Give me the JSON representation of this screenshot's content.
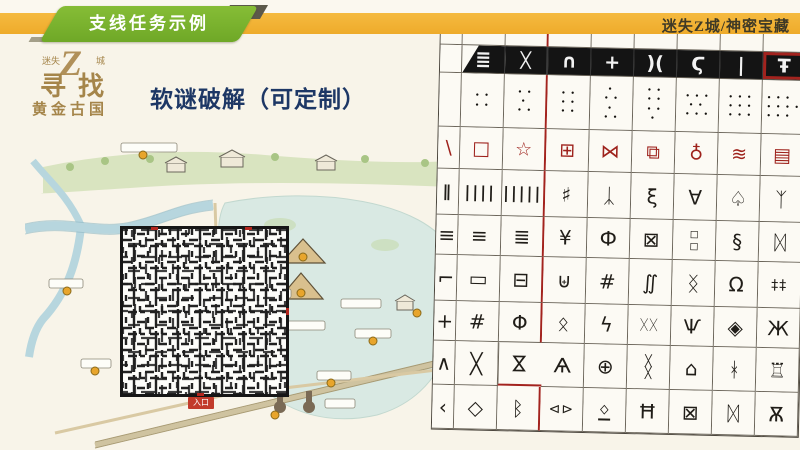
{
  "header": {
    "bar_color": "#F1B134",
    "badge": {
      "label": "支线任务示例",
      "color": "#77B22B"
    },
    "project": "迷失Z城/神密宝藏"
  },
  "logo": {
    "top_left": "迷失",
    "z": "Z",
    "top_right": "城",
    "mid": "寻找",
    "bottom": "黄金古国",
    "gold_color": "#A5854A"
  },
  "title": "软谜破解（可定制）",
  "title_color": "#1D3765",
  "map": {
    "entrance_label": "入口",
    "maze": "black-and-white square maze overlay",
    "marker_color": "#E8A52C"
  },
  "table": {
    "accent_red": "#A3231E",
    "description": "grid of ancient pictographic numeral symbols, slightly tilted, right edge cropped",
    "rows": [
      [
        {
          "g": ""
        },
        {
          "g": ""
        },
        {
          "g": ""
        },
        {
          "g": ""
        },
        {
          "g": ""
        },
        {
          "g": ""
        },
        {
          "g": ""
        },
        {
          "g": ""
        },
        {
          "g": ""
        }
      ],
      [
        {
          "g": ""
        },
        {
          "g": "≣",
          "k": "band bandL"
        },
        {
          "g": "ᚷ",
          "k": "band"
        },
        {
          "g": "∩",
          "k": "band"
        },
        {
          "g": "+",
          "k": "band"
        },
        {
          "g": ")(",
          "k": "band"
        },
        {
          "g": "Ϛ",
          "k": "band"
        },
        {
          "g": "|",
          "k": "band"
        },
        {
          "g": "Ŧ",
          "k": "band redbox"
        }
      ],
      [
        {
          "g": "",
          "k": "dots"
        },
        {
          "g": "• •\n• •",
          "k": "dots"
        },
        {
          "g": "• •\n •\n• •",
          "k": "dots"
        },
        {
          "g": "• •\n• •\n• •",
          "k": "dots"
        },
        {
          "g": " •\n• •\n •\n• •",
          "k": "dots"
        },
        {
          "g": "• •\n• •\n• •\n •",
          "k": "dots"
        },
        {
          "g": "• • •\n • •\n• • •",
          "k": "dots"
        },
        {
          "g": "• • •\n• • •\n• • •",
          "k": "dots"
        },
        {
          "g": "• • •\n• • • •\n• • •",
          "k": "dots"
        }
      ],
      [
        {
          "g": "\\",
          "k": "red"
        },
        {
          "g": "□",
          "k": "red"
        },
        {
          "g": "☆",
          "k": "red"
        },
        {
          "g": "⊞",
          "k": "red"
        },
        {
          "g": "⋈",
          "k": "red"
        },
        {
          "g": "⧉",
          "k": "red"
        },
        {
          "g": "♁",
          "k": "red"
        },
        {
          "g": "≋",
          "k": "red"
        },
        {
          "g": "▤",
          "k": "red"
        }
      ],
      [
        {
          "g": "∥",
          "k": "tally"
        },
        {
          "g": "||||",
          "k": "tally"
        },
        {
          "g": "|||||",
          "k": "tally"
        },
        {
          "g": "♯"
        },
        {
          "g": "ᛣ"
        },
        {
          "g": "ξ"
        },
        {
          "g": "∀"
        },
        {
          "g": "♤"
        },
        {
          "g": "ᛉ"
        }
      ],
      [
        {
          "g": "≡"
        },
        {
          "g": "≡"
        },
        {
          "g": "≣"
        },
        {
          "g": "¥"
        },
        {
          "g": "Ф"
        },
        {
          "g": "⊠"
        },
        {
          "g": "◻\n◻",
          "k": "small"
        },
        {
          "g": "§"
        },
        {
          "g": "ᛞ"
        }
      ],
      [
        {
          "g": "⌐"
        },
        {
          "g": "▭"
        },
        {
          "g": "⊟"
        },
        {
          "g": "⊎"
        },
        {
          "g": "#"
        },
        {
          "g": "∬"
        },
        {
          "g": "ᛝ"
        },
        {
          "g": "Ω"
        },
        {
          "g": "‡‡",
          "k": "mid2"
        }
      ],
      [
        {
          "g": "+"
        },
        {
          "g": "#"
        },
        {
          "g": "Φ"
        },
        {
          "g": "ᛟ"
        },
        {
          "g": "ϟ"
        },
        {
          "g": "ᚷᚷ",
          "k": "mid2"
        },
        {
          "g": "Ѱ"
        },
        {
          "g": "◈"
        },
        {
          "g": "Ж"
        }
      ],
      [
        {
          "g": "∧"
        },
        {
          "g": "╳"
        },
        {
          "g": "⋈",
          "k": "rot"
        },
        {
          "g": "Ѧ"
        },
        {
          "g": "⊕"
        },
        {
          "g": "╳\n╳",
          "k": "small"
        },
        {
          "g": "⌂"
        },
        {
          "g": "ᚼ"
        },
        {
          "g": "♖"
        }
      ],
      [
        {
          "g": "‹"
        },
        {
          "g": "◇"
        },
        {
          "g": "ᛒ"
        },
        {
          "g": "⊲⊳",
          "k": "mid2"
        },
        {
          "g": "ᛜ",
          "k": "ul"
        },
        {
          "g": "Ħ"
        },
        {
          "g": "⊠"
        },
        {
          "g": "ᛞ"
        },
        {
          "g": "Ѫ"
        }
      ]
    ]
  }
}
